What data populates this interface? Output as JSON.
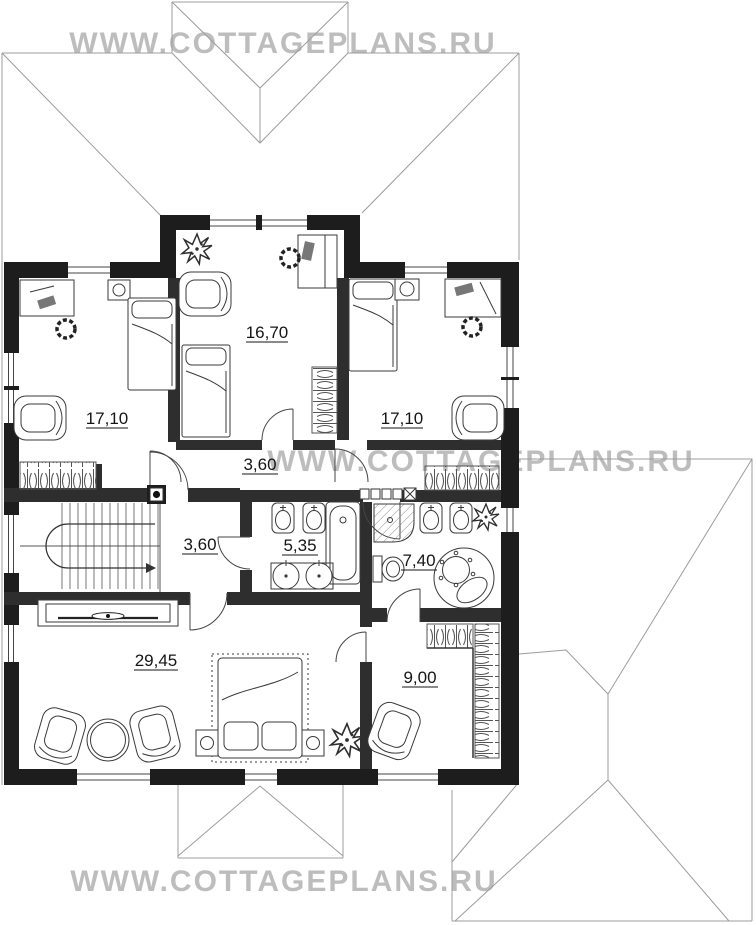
{
  "site": {
    "watermark_text": "WWW.COTTAGEPLANS.RU"
  },
  "watermarks": {
    "top": "WWW.COTTAGEPLANS.RU",
    "middle": "WWW.COTTAGEPLANS.RU",
    "bottom": "WWW.COTTAGEPLANS.RU"
  },
  "plan": {
    "floor_type": "second-floor cottage plan",
    "rooms": [
      {
        "id": "bedroom-top-center",
        "area": "16,70"
      },
      {
        "id": "bedroom-top-left",
        "area": "17,10"
      },
      {
        "id": "bedroom-top-right",
        "area": "17,10"
      },
      {
        "id": "hall-upper",
        "area": "3,60"
      },
      {
        "id": "hall-stairs",
        "area": "3,60"
      },
      {
        "id": "bathroom",
        "area": "5,35"
      },
      {
        "id": "master-bathroom",
        "area": "7,40"
      },
      {
        "id": "master-bedroom",
        "area": "29,45"
      },
      {
        "id": "wardrobe",
        "area": "9,00"
      }
    ]
  },
  "colors": {
    "exterior_wall": "#1d1d1d",
    "interior_wall": "#2e2e2e",
    "roof_line": "#9c9c9c",
    "watermark": "#adadad",
    "furniture_line": "#3a3a3a",
    "label_text": "#151515"
  }
}
